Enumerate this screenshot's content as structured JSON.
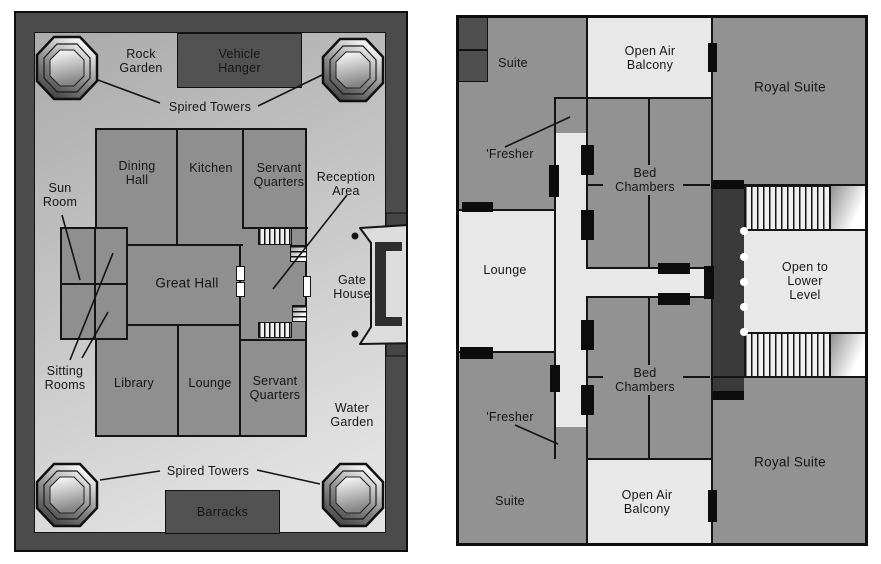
{
  "left_plan": {
    "labels": {
      "rock_garden": "Rock\nGarden",
      "vehicle_hanger": "Vehicle\nHanger",
      "spired_towers_top": "Spired Towers",
      "sun_room": "Sun\nRoom",
      "dining_hall": "Dining\nHall",
      "kitchen": "Kitchen",
      "servant_quarters_north": "Servant\nQuarters",
      "reception_area": "Reception\nArea",
      "great_hall": "Great Hall",
      "gate_house": "Gate\nHouse",
      "sitting_rooms": "Sitting\nRooms",
      "library": "Library",
      "lounge": "Lounge",
      "servant_quarters_south": "Servant\nQuarters",
      "water_garden": "Water\nGarden",
      "spired_towers_bottom": "Spired Towers",
      "barracks": "Barracks"
    }
  },
  "right_plan": {
    "labels": {
      "suite_north": "Suite",
      "open_air_balcony_north": "Open Air\nBalcony",
      "royal_suite_north": "Royal Suite",
      "fresher_north": "'Fresher",
      "bed_chambers_north": "Bed\nChambers",
      "lounge": "Lounge",
      "open_to_lower_level": "Open to\nLower Level",
      "bed_chambers_south": "Bed\nChambers",
      "fresher_south": "'Fresher",
      "suite_south": "Suite",
      "open_air_balcony_south": "Open Air\nBalcony",
      "royal_suite_south": "Royal Suite"
    }
  },
  "colors": {
    "wall_dark": "#4b4b4b",
    "building_gray": "#8f8f8f",
    "room_gray": "#929292",
    "courtyard_light": "#c8c8c8",
    "dark_room": "#525252",
    "light_area": "#e8e8e8",
    "corridor_dark": "#3a3a3a",
    "outline": "#141414",
    "door_white": "#ffffff",
    "page_background": "#ffffff"
  }
}
